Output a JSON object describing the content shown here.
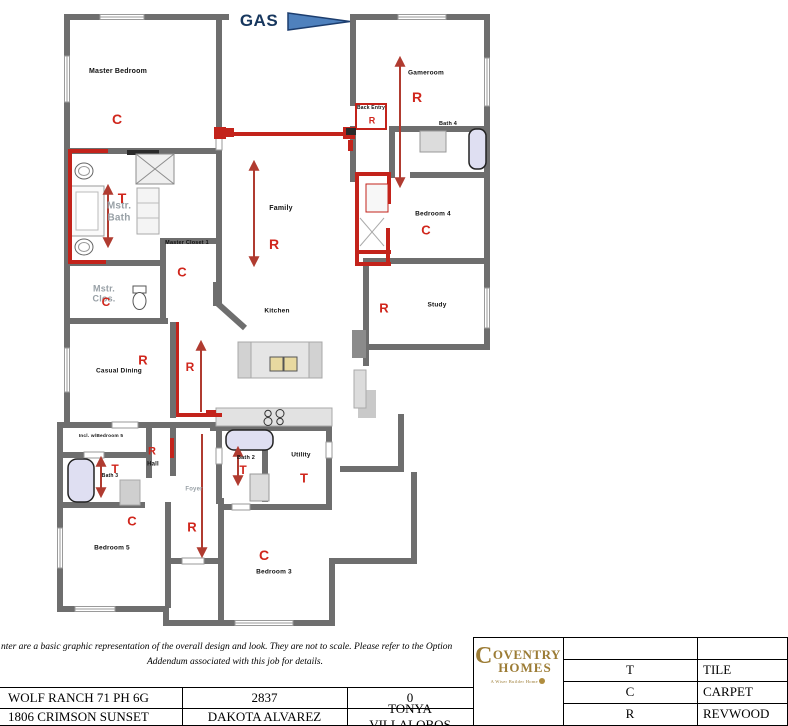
{
  "gas_label": "GAS",
  "rooms": {
    "master_bedroom": "Master Bedroom",
    "gameroom": "Gameroom",
    "back_entry": "Back Entry",
    "bath4": "Bath 4",
    "bedroom4": "Bedroom 4",
    "study": "Study",
    "family": "Family",
    "kitchen": "Kitchen",
    "casual_dining": "Casual Dining",
    "mstr_bath": "Mstr.\nBath",
    "master_closet1": "Master Closet 1",
    "mstr_clos": "Mstr.\nClos.",
    "incl_w_bedroom5": "Incl. w/Bedroom 5",
    "hall": "Hall",
    "bath3": "Bath 3",
    "bedroom5": "Bedroom 5",
    "foyer": "Foyer",
    "bath2": "Bath 2",
    "utility": "Utility",
    "bedroom3": "Bedroom 3"
  },
  "marks": {
    "master_bedroom": "C",
    "mstr_bath": "T",
    "master_closet1": "C",
    "mstr_clos": "C",
    "family": "R",
    "gameroom": "R",
    "back_entry": "R",
    "bedroom4": "C",
    "study": "R",
    "casual_dining": "R",
    "gallery": "R",
    "hall": "R",
    "bath3": "T",
    "bedroom5": "C",
    "foyer": "R",
    "bath2": "T",
    "utility": "T",
    "bedroom3": "C"
  },
  "legend": {
    "rows": [
      {
        "code": "T",
        "material": "TILE"
      },
      {
        "code": "C",
        "material": "CARPET"
      },
      {
        "code": "R",
        "material": "REVWOOD"
      }
    ]
  },
  "footer": {
    "disclaimer_line1": "nter are a basic graphic representation of the overall design and look. They are not to scale. Please refer to the Option",
    "disclaimer_line2": "Addendum associated with this job for details.",
    "community": "WOLF RANCH 71 PH 6G",
    "plan_number": "2837",
    "elevation": "0",
    "address": "1806 CRIMSON SUNSET",
    "designer": "DAKOTA ALVAREZ",
    "consultant": "TONYA VILLALOBOS"
  },
  "brand": {
    "initial": "C",
    "rest": "OVENTRY",
    "line2": "HOMES",
    "tagline": "A Wiser Builder Home"
  },
  "colors": {
    "wall_gray": "#6e6e6e",
    "highlight_red": "#c3231b",
    "mark_red": "#d0261c",
    "gas_blue": "#4f81bd",
    "brand_gold": "#9c7c35"
  }
}
